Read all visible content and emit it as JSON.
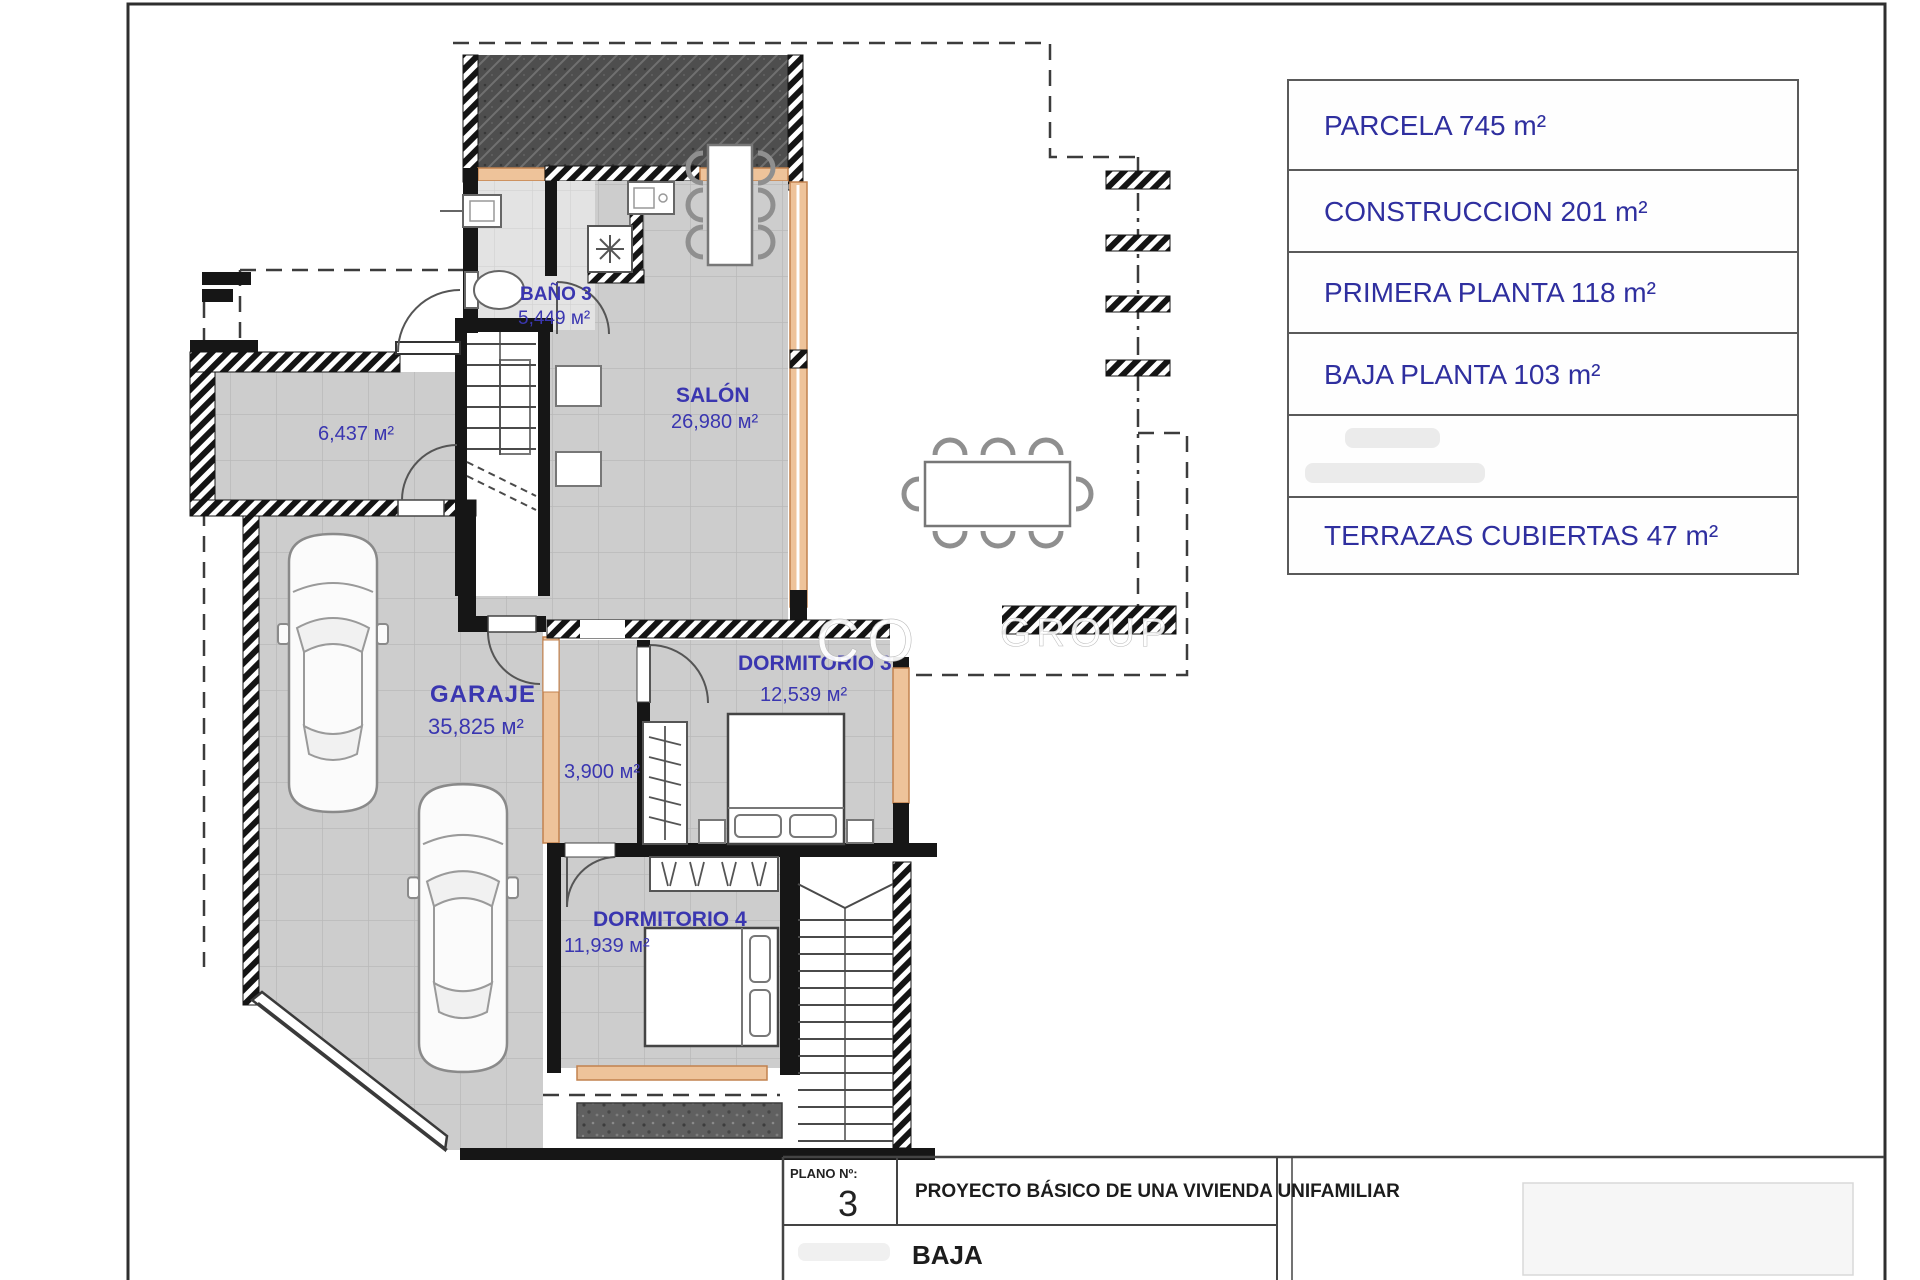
{
  "plan": {
    "rooms": {
      "bano3": {
        "name": "BAÑO 3",
        "area": "5,449 м²"
      },
      "salon": {
        "name": "SALÓN",
        "area": "26,980 м²"
      },
      "trastero": {
        "area": "6,437 м²"
      },
      "garaje": {
        "name": "GARAJE",
        "area": "35,825 м²"
      },
      "pasillo": {
        "area": "3,900 м²"
      },
      "dormitorio3": {
        "name": "DORMITORIO 3",
        "area": "12,539 м²"
      },
      "dormitorio4": {
        "name": "DORMITORIO 4",
        "area": "11,939 м²"
      }
    },
    "watermark": {
      "left": "CO",
      "right": "GROUP"
    }
  },
  "info_table": {
    "rows": [
      "PARCELA 745 m²",
      "CONSTRUCCION 201 m²",
      "PRIMERA PLANTA 118 m²",
      "BAJA PLANTA 103 m²",
      "",
      "TERRAZAS CUBIERTAS 47 m²"
    ]
  },
  "title_block": {
    "plano_label": "PLANO Nº:",
    "plano_number": "3",
    "project_title": "PROYECTO BÁSICO DE UNA VIVIENDA UNIFAMILIAR",
    "floor_label": "BAJA"
  },
  "colors": {
    "label_blue": "#3a36b0",
    "table_blue": "#2f2f9f",
    "window_orange": "#eec39a",
    "wall_black": "#161616"
  }
}
